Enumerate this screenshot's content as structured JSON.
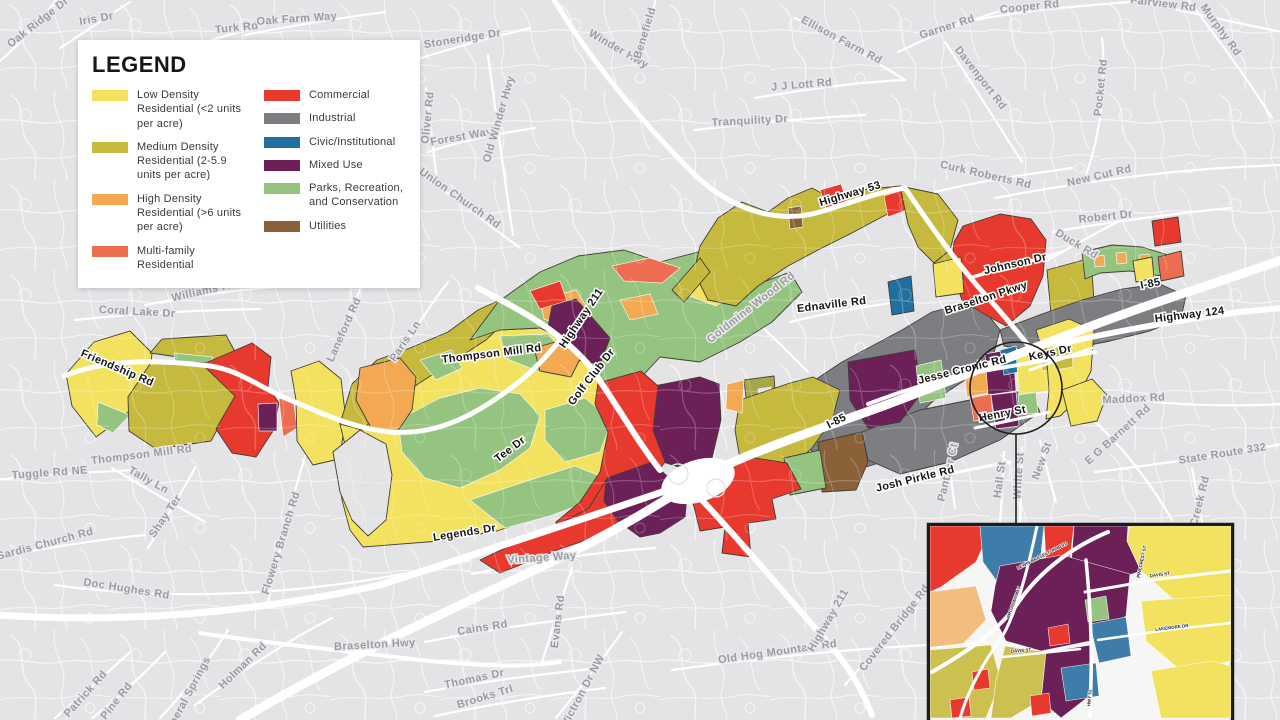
{
  "legend": {
    "title": "LEGEND",
    "column1": [
      {
        "label": "Low Density Residential (<2 units per acre)",
        "color": "#f3e25f"
      },
      {
        "label": "Medium Density Residential (2-5.9 units per acre)",
        "color": "#c6ba3e"
      },
      {
        "label": "High Density Residential (>6 units per acre)",
        "color": "#f2a952"
      },
      {
        "label": "Multi-family Residential",
        "color": "#ed6d50"
      }
    ],
    "column2": [
      {
        "label": "Commercial",
        "color": "#e8392e"
      },
      {
        "label": "Industrial",
        "color": "#7d7e82"
      },
      {
        "label": "Civic/Institutional",
        "color": "#20709f"
      },
      {
        "label": "Mixed Use",
        "color": "#6b2058"
      },
      {
        "label": "Parks, Recreation, and Conservation",
        "color": "#94c47f"
      },
      {
        "label": "Utilities",
        "color": "#8a6139"
      }
    ]
  },
  "map": {
    "background_color": "#e4e4e7",
    "road_color": "#ffffff",
    "gray_road_labels": [
      {
        "text": "Oak Ridge Dr",
        "x": 40,
        "y": 25,
        "r": -38
      },
      {
        "text": "Iris Dr",
        "x": 97,
        "y": 22,
        "r": -10
      },
      {
        "text": "Turk Rd",
        "x": 237,
        "y": 31,
        "r": -6
      },
      {
        "text": "Oak Farm Way",
        "x": 297,
        "y": 22,
        "r": -4
      },
      {
        "text": "Stoneridge Dr",
        "x": 463,
        "y": 42,
        "r": -9
      },
      {
        "text": "Winder Hwy",
        "x": 617,
        "y": 52,
        "r": 30
      },
      {
        "text": "Benefield",
        "x": 648,
        "y": 34,
        "r": -73
      },
      {
        "text": "Ellison Farm Rd",
        "x": 840,
        "y": 43,
        "r": 28
      },
      {
        "text": "Garner Rd",
        "x": 948,
        "y": 30,
        "r": -18
      },
      {
        "text": "Cooper Rd",
        "x": 1030,
        "y": 10,
        "r": -6
      },
      {
        "text": "Fairview Rd",
        "x": 1163,
        "y": 7,
        "r": 7
      },
      {
        "text": "Murphy Rd",
        "x": 1218,
        "y": 32,
        "r": 54
      },
      {
        "text": "Davenport Rd",
        "x": 978,
        "y": 80,
        "r": 52
      },
      {
        "text": "Pocket Rd",
        "x": 1104,
        "y": 88,
        "r": -84
      },
      {
        "text": "J J Lott Rd",
        "x": 802,
        "y": 88,
        "r": -5
      },
      {
        "text": "Tranquility Dr",
        "x": 750,
        "y": 124,
        "r": -3
      },
      {
        "text": "Forest Way",
        "x": 462,
        "y": 140,
        "r": -10
      },
      {
        "text": "Oliver Rd",
        "x": 431,
        "y": 118,
        "r": -84
      },
      {
        "text": "Old Winder Hwy",
        "x": 502,
        "y": 120,
        "r": -74
      },
      {
        "text": "Union Church Rd",
        "x": 458,
        "y": 201,
        "r": 35
      },
      {
        "text": "Curk Roberts Rd",
        "x": 985,
        "y": 178,
        "r": 13
      },
      {
        "text": "New Cut Rd",
        "x": 1100,
        "y": 179,
        "r": -13
      },
      {
        "text": "Robert Dr",
        "x": 1106,
        "y": 220,
        "r": -6
      },
      {
        "text": "Duck Rd",
        "x": 1075,
        "y": 247,
        "r": 31
      },
      {
        "text": "Goldmine Wood Rd",
        "x": 753,
        "y": 310,
        "r": -38
      },
      {
        "text": "Williams Rd",
        "x": 205,
        "y": 294,
        "r": -13
      },
      {
        "text": "Coral Lake Dr",
        "x": 137,
        "y": 315,
        "r": 3
      },
      {
        "text": "Laneford Rd",
        "x": 347,
        "y": 331,
        "r": -66
      },
      {
        "text": "Paris Ln",
        "x": 408,
        "y": 343,
        "r": -56
      },
      {
        "text": "Thompson Mill Rd",
        "x": 142,
        "y": 458,
        "r": -7
      },
      {
        "text": "Tuggle Rd NE",
        "x": 50,
        "y": 476,
        "r": -4
      },
      {
        "text": "Tally Ln",
        "x": 147,
        "y": 483,
        "r": 29
      },
      {
        "text": "Shay Ter",
        "x": 168,
        "y": 518,
        "r": -56
      },
      {
        "text": "Sardis Church Rd",
        "x": 46,
        "y": 547,
        "r": -15
      },
      {
        "text": "Doc Hughes Rd",
        "x": 126,
        "y": 592,
        "r": 9
      },
      {
        "text": "Flowery Branch Rd",
        "x": 284,
        "y": 544,
        "r": -73
      },
      {
        "text": "Braselton Hwy",
        "x": 375,
        "y": 648,
        "r": -3
      },
      {
        "text": "Holman Rd",
        "x": 245,
        "y": 668,
        "r": -44
      },
      {
        "text": "Patrick Rd",
        "x": 88,
        "y": 696,
        "r": -48
      },
      {
        "text": "Pine Rd",
        "x": 119,
        "y": 703,
        "r": -52
      },
      {
        "text": "Mineral Springs",
        "x": 190,
        "y": 698,
        "r": -62
      },
      {
        "text": "Thomas Dr",
        "x": 475,
        "y": 682,
        "r": -12
      },
      {
        "text": "Brooks Trl",
        "x": 486,
        "y": 700,
        "r": -17
      },
      {
        "text": "Victron Dr NW",
        "x": 586,
        "y": 692,
        "r": -62
      },
      {
        "text": "Cains Rd",
        "x": 483,
        "y": 631,
        "r": -9
      },
      {
        "text": "Evans Rd",
        "x": 561,
        "y": 622,
        "r": -83
      },
      {
        "text": "Vintage Way",
        "x": 542,
        "y": 561,
        "r": -4
      },
      {
        "text": "Old Hog Mountain Rd",
        "x": 778,
        "y": 655,
        "r": -8
      },
      {
        "text": "Highway 211",
        "x": 831,
        "y": 622,
        "r": -60
      },
      {
        "text": "Covered Bridge Rd",
        "x": 897,
        "y": 630,
        "r": -52
      },
      {
        "text": "Maddox Rd",
        "x": 1134,
        "y": 402,
        "r": -3
      },
      {
        "text": "E G Barnett Rd",
        "x": 1120,
        "y": 437,
        "r": -42
      },
      {
        "text": "State Route 332",
        "x": 1223,
        "y": 457,
        "r": -9
      },
      {
        "text": "Creek Rd",
        "x": 1203,
        "y": 502,
        "r": -76
      },
      {
        "text": "Panther Ct",
        "x": 951,
        "y": 473,
        "r": -77
      },
      {
        "text": "Hall St",
        "x": 1003,
        "y": 480,
        "r": -82
      },
      {
        "text": "White St",
        "x": 1022,
        "y": 476,
        "r": -86
      },
      {
        "text": "New St",
        "x": 1045,
        "y": 462,
        "r": -70
      }
    ],
    "dark_road_labels": [
      {
        "text": "Highway 53",
        "x": 851,
        "y": 197,
        "r": -17
      },
      {
        "text": "Highway 211",
        "x": 584,
        "y": 320,
        "r": -56
      },
      {
        "text": "Thompson Mill Rd",
        "x": 492,
        "y": 357,
        "r": -7
      },
      {
        "text": "Golf Club Dr",
        "x": 594,
        "y": 379,
        "r": -52
      },
      {
        "text": "Tee Dr",
        "x": 512,
        "y": 452,
        "r": -37
      },
      {
        "text": "Friendship Rd",
        "x": 116,
        "y": 371,
        "r": 23
      },
      {
        "text": "Legends Dr",
        "x": 465,
        "y": 536,
        "r": -9
      },
      {
        "text": "I-85",
        "x": 838,
        "y": 424,
        "r": -27
      },
      {
        "text": "I-85",
        "x": 1151,
        "y": 287,
        "r": -11
      },
      {
        "text": "Johnson Dr",
        "x": 1016,
        "y": 267,
        "r": -13
      },
      {
        "text": "Braselton Pkwy",
        "x": 987,
        "y": 301,
        "r": -18
      },
      {
        "text": "Highway 124",
        "x": 1190,
        "y": 318,
        "r": -7
      },
      {
        "text": "Keys Dr",
        "x": 1051,
        "y": 356,
        "r": -12
      },
      {
        "text": "Jesse Cronic Rd",
        "x": 963,
        "y": 373,
        "r": -14
      },
      {
        "text": "Henry St",
        "x": 1003,
        "y": 417,
        "r": -11
      },
      {
        "text": "Josh Pirkle Rd",
        "x": 916,
        "y": 482,
        "r": -14
      },
      {
        "text": "Ednaville Rd",
        "x": 832,
        "y": 308,
        "r": -7
      }
    ],
    "inset": {
      "street_labels": [
        {
          "text": "LEWIS BRASELTON BLVD",
          "x": 1043,
          "y": 557,
          "r": -27
        },
        {
          "text": "BROADWAY AV",
          "x": 1015,
          "y": 603,
          "r": -70
        },
        {
          "text": "DAVIS ST",
          "x": 1021,
          "y": 652,
          "r": -4
        },
        {
          "text": "DAVIS ST",
          "x": 1160,
          "y": 576,
          "r": -8
        },
        {
          "text": "LAKEMORE DR",
          "x": 1172,
          "y": 629,
          "r": -7
        },
        {
          "text": "PINECREST ST",
          "x": 1143,
          "y": 562,
          "r": -78
        },
        {
          "text": "HWY 53",
          "x": 1091,
          "y": 698,
          "r": -85
        }
      ]
    }
  }
}
